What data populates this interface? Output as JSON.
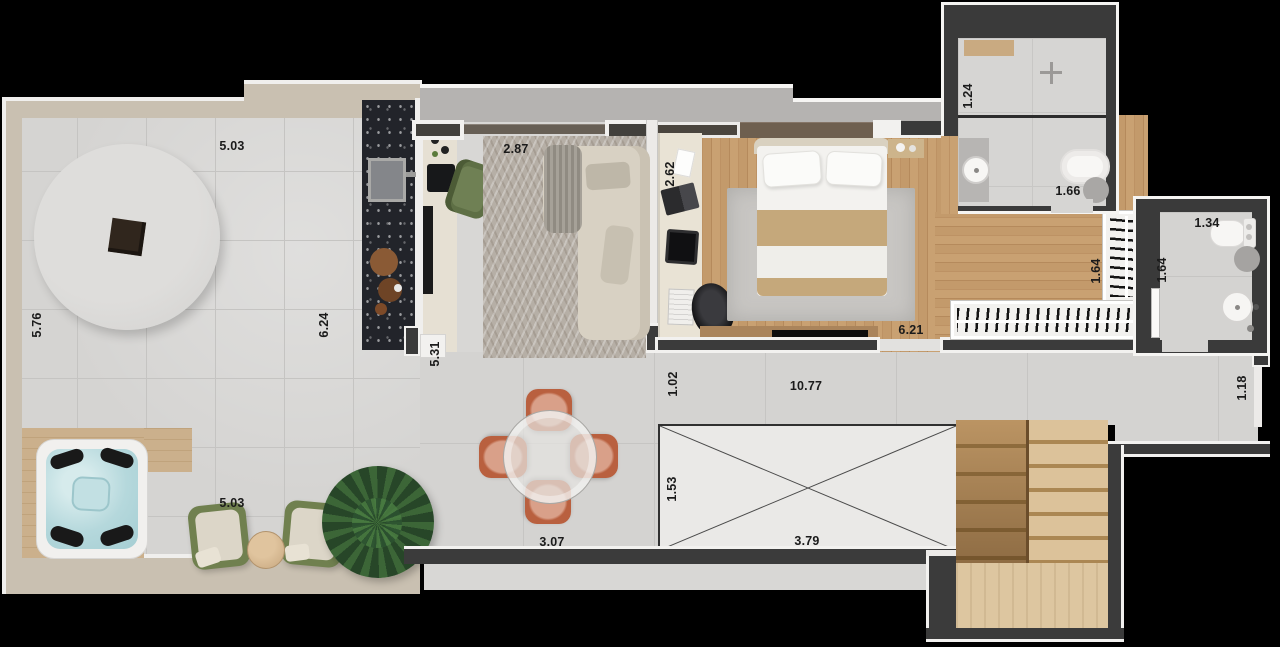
{
  "type": "apartment-floor-plan-render",
  "dimension_labels": [
    {
      "text": "5.03",
      "x": 232,
      "y": 146,
      "orientation": "horizontal"
    },
    {
      "text": "2.87",
      "x": 516,
      "y": 149,
      "orientation": "horizontal"
    },
    {
      "text": "2.62",
      "x": 670,
      "y": 174,
      "orientation": "vertical"
    },
    {
      "text": "1.24",
      "x": 968,
      "y": 96,
      "orientation": "vertical"
    },
    {
      "text": "1.66",
      "x": 1068,
      "y": 191,
      "orientation": "horizontal"
    },
    {
      "text": "1.34",
      "x": 1207,
      "y": 223,
      "orientation": "horizontal"
    },
    {
      "text": "5.76",
      "x": 37,
      "y": 325,
      "orientation": "vertical"
    },
    {
      "text": "6.24",
      "x": 324,
      "y": 325,
      "orientation": "vertical"
    },
    {
      "text": "5.31",
      "x": 435,
      "y": 354,
      "orientation": "vertical"
    },
    {
      "text": "1.64",
      "x": 1096,
      "y": 271,
      "orientation": "vertical"
    },
    {
      "text": "1.64",
      "x": 1162,
      "y": 270,
      "orientation": "vertical"
    },
    {
      "text": "6.21",
      "x": 911,
      "y": 330,
      "orientation": "horizontal"
    },
    {
      "text": "1.02",
      "x": 673,
      "y": 384,
      "orientation": "vertical"
    },
    {
      "text": "10.77",
      "x": 806,
      "y": 386,
      "orientation": "horizontal"
    },
    {
      "text": "1.18",
      "x": 1242,
      "y": 388,
      "orientation": "vertical"
    },
    {
      "text": "1.53",
      "x": 672,
      "y": 489,
      "orientation": "vertical"
    },
    {
      "text": "3.79",
      "x": 807,
      "y": 541,
      "orientation": "horizontal"
    },
    {
      "text": "5.03",
      "x": 232,
      "y": 503,
      "orientation": "horizontal"
    },
    {
      "text": "3.07",
      "x": 552,
      "y": 542,
      "orientation": "horizontal"
    }
  ],
  "colors": {
    "background": "#000000",
    "wall_dark": "#3b3b3b",
    "wall_trim": "#f2f1ef",
    "terrace_parapet": "#c9c0b1",
    "tile_floor": "#d5d4d2",
    "wood_floor": "#c39a6b",
    "kitchen_island_granite": "#22242a",
    "carpet": "#b6afa6",
    "sofa": "#d8d1c3",
    "blanket_tan": "#c5a87b",
    "hot_tub_water": "#b5d8dc",
    "lounge_green": "#70804f",
    "dining_chair_terracotta": "#b9603f",
    "stairs_wood": "#c2a06e",
    "label_text": "#1b1b1b"
  },
  "furniture_inventory": [
    "round-lounge-platform",
    "fire-pit",
    "hot-tub",
    "wood-deck",
    "lounge-chair",
    "lounge-chair",
    "side-table",
    "palm-plant",
    "dining-table",
    "dining-chair-x4",
    "kitchen-island",
    "kitchen-sink",
    "cutting-boards",
    "kitchen-counter",
    "cooktop",
    "armchair",
    "sofa",
    "curtain",
    "living-carpet",
    "built-in-desk",
    "laptop",
    "tablet",
    "keyboard",
    "office-chair",
    "double-bed",
    "pillows",
    "bedside-table",
    "area-rug",
    "tv-console",
    "clothes-rack",
    "clothes-rack",
    "shower",
    "washbasin",
    "bathtub",
    "stool",
    "toilet",
    "washbasin-2",
    "stool-2",
    "void-shaft",
    "staircase"
  ]
}
